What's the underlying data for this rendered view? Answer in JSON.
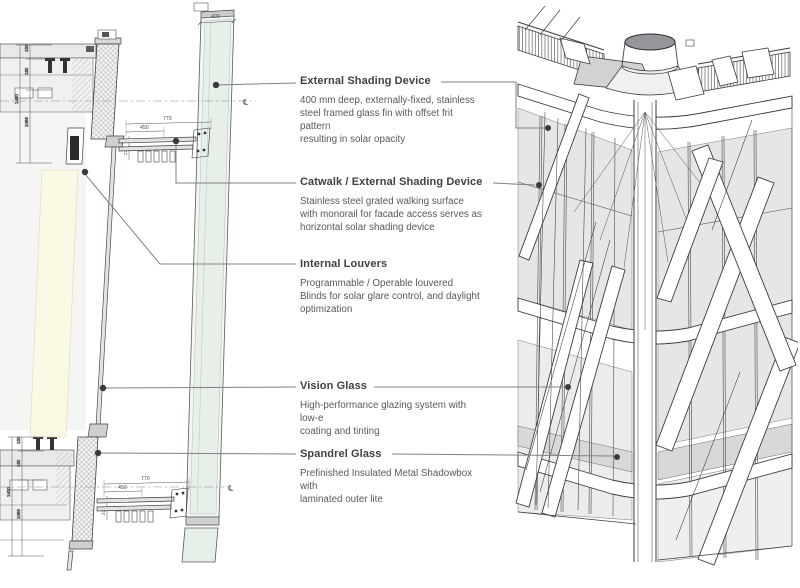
{
  "annotations": [
    {
      "title": "External Shading Device",
      "body": "400 mm deep, externally-fixed, stainless\nsteel framed glass fin with offset frit pattern\nresulting in solar opacity"
    },
    {
      "title": "Catwalk / External Shading Device",
      "body": "Stainless steel grated walking surface\nwith monorail for facade access serves as\nhorizontal solar shading device"
    },
    {
      "title": "Internal Louvers",
      "body": "Programmable / Operable louvered\nBlinds for solar glare control, and daylight\noptimization"
    },
    {
      "title": "Vision Glass",
      "body": "High-performance glazing system with low-e\ncoating and tinting"
    },
    {
      "title": "Spandrel Glass",
      "body": "Prefinished Insulated Metal Shadowbox with\nlaminated outer lite"
    }
  ],
  "dims": {
    "fin400": "400",
    "len770": "770",
    "mid450": "450",
    "h225": "225",
    "a100": "100",
    "b35": "35",
    "s150": "150",
    "s180": "180",
    "t1400": "1400",
    "s1069": "1069"
  },
  "symbols": {
    "centerline": "℄"
  },
  "colors": {
    "leader": "#808184",
    "dot": "#3a3a3c",
    "line": "#414042",
    "glass_3d": "#e6e6e8",
    "spandrel_3d": "#d8d8da",
    "fin_glass": "#e7efe9",
    "louver_cream": "#fbf8e3",
    "slab_gray": "#e9e9e9",
    "cylinder_gray": "#96969a"
  }
}
